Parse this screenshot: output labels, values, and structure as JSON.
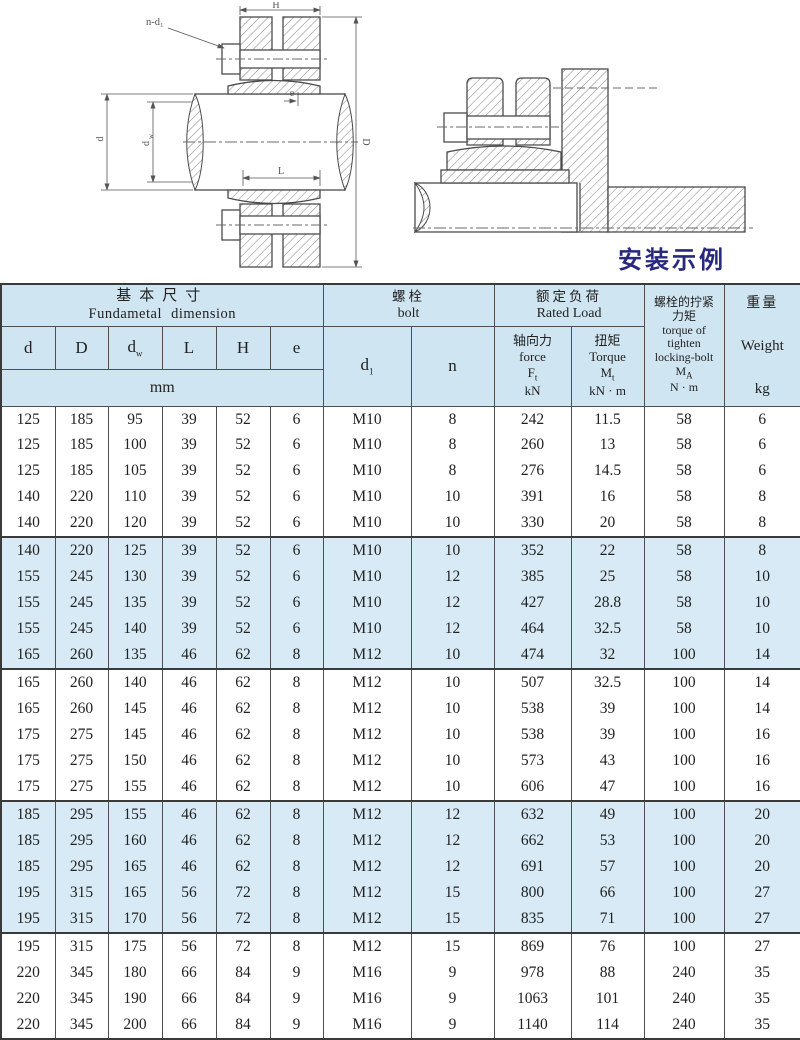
{
  "caption": "安装示例",
  "colors": {
    "caption": "#28287f",
    "header_bg": "#cfe5f1",
    "shaded_row_bg": "#d7eaf5",
    "grid_line": "#4f4f4f",
    "drawing_line": "#4a4a4a"
  },
  "drawing_labels": {
    "H": "H",
    "n_d1": "n-d₁",
    "d": "d",
    "dw_base": "d",
    "dw_sub": "w",
    "e": "e",
    "L": "L",
    "D": "D"
  },
  "table": {
    "groups": {
      "basic": {
        "cn": "基本尺寸",
        "en": "Fundametal dimension",
        "unit": "mm"
      },
      "bolt": {
        "cn": "螺栓",
        "en": "bolt"
      },
      "rated": {
        "cn": "额定负荷",
        "en": "Rated Load"
      },
      "tighten": {
        "cn1": "螺栓的拧紧",
        "cn2": "力矩",
        "en1": "torque of",
        "en2": "tighten",
        "en3": "locking-bolt",
        "sym_base": "M",
        "sym_sub": "A",
        "unit": "N · m"
      },
      "weight": {
        "cn": "重量",
        "en": "Weight",
        "unit": "kg"
      }
    },
    "cols": {
      "d": "d",
      "D": "D",
      "dw_base": "d",
      "dw_sub": "w",
      "L": "L",
      "H": "H",
      "e": "e",
      "d1_base": "d",
      "d1_sub": "1",
      "n": "n",
      "force": {
        "cn": "轴向力",
        "en": "force",
        "sym_base": "F",
        "sym_sub": "t",
        "unit": "kN"
      },
      "torque": {
        "cn": "扭矩",
        "en": "Torque",
        "sym_base": "M",
        "sym_sub": "t",
        "unit": "kN · m"
      }
    },
    "rows": [
      {
        "shaded": false,
        "section_start": false,
        "cells": [
          125,
          185,
          95,
          39,
          52,
          6,
          "M10",
          8,
          242,
          "11.5",
          58,
          6
        ]
      },
      {
        "shaded": false,
        "section_start": false,
        "cells": [
          125,
          185,
          100,
          39,
          52,
          6,
          "M10",
          8,
          260,
          13,
          58,
          6
        ]
      },
      {
        "shaded": false,
        "section_start": false,
        "cells": [
          125,
          185,
          105,
          39,
          52,
          6,
          "M10",
          8,
          276,
          "14.5",
          58,
          6
        ]
      },
      {
        "shaded": false,
        "section_start": false,
        "cells": [
          140,
          220,
          110,
          39,
          52,
          6,
          "M10",
          10,
          391,
          16,
          58,
          8
        ]
      },
      {
        "shaded": false,
        "section_start": false,
        "cells": [
          140,
          220,
          120,
          39,
          52,
          6,
          "M10",
          10,
          330,
          20,
          58,
          8
        ]
      },
      {
        "shaded": true,
        "section_start": true,
        "cells": [
          140,
          220,
          125,
          39,
          52,
          6,
          "M10",
          10,
          352,
          22,
          58,
          8
        ]
      },
      {
        "shaded": true,
        "section_start": false,
        "cells": [
          155,
          245,
          130,
          39,
          52,
          6,
          "M10",
          12,
          385,
          25,
          58,
          10
        ]
      },
      {
        "shaded": true,
        "section_start": false,
        "cells": [
          155,
          245,
          135,
          39,
          52,
          6,
          "M10",
          12,
          427,
          "28.8",
          58,
          10
        ]
      },
      {
        "shaded": true,
        "section_start": false,
        "cells": [
          155,
          245,
          140,
          39,
          52,
          6,
          "M10",
          12,
          464,
          "32.5",
          58,
          10
        ]
      },
      {
        "shaded": true,
        "section_start": false,
        "cells": [
          165,
          260,
          135,
          46,
          62,
          8,
          "M12",
          10,
          474,
          32,
          100,
          14
        ]
      },
      {
        "shaded": false,
        "section_start": true,
        "cells": [
          165,
          260,
          140,
          46,
          62,
          8,
          "M12",
          10,
          507,
          "32.5",
          100,
          14
        ]
      },
      {
        "shaded": false,
        "section_start": false,
        "cells": [
          165,
          260,
          145,
          46,
          62,
          8,
          "M12",
          10,
          538,
          39,
          100,
          14
        ]
      },
      {
        "shaded": false,
        "section_start": false,
        "cells": [
          175,
          275,
          145,
          46,
          62,
          8,
          "M12",
          10,
          538,
          39,
          100,
          16
        ]
      },
      {
        "shaded": false,
        "section_start": false,
        "cells": [
          175,
          275,
          150,
          46,
          62,
          8,
          "M12",
          10,
          573,
          43,
          100,
          16
        ]
      },
      {
        "shaded": false,
        "section_start": false,
        "cells": [
          175,
          275,
          155,
          46,
          62,
          8,
          "M12",
          10,
          606,
          47,
          100,
          16
        ]
      },
      {
        "shaded": true,
        "section_start": true,
        "cells": [
          185,
          295,
          155,
          46,
          62,
          8,
          "M12",
          12,
          632,
          49,
          100,
          20
        ]
      },
      {
        "shaded": true,
        "section_start": false,
        "cells": [
          185,
          295,
          160,
          46,
          62,
          8,
          "M12",
          12,
          662,
          53,
          100,
          20
        ]
      },
      {
        "shaded": true,
        "section_start": false,
        "cells": [
          185,
          295,
          165,
          46,
          62,
          8,
          "M12",
          12,
          691,
          57,
          100,
          20
        ]
      },
      {
        "shaded": true,
        "section_start": false,
        "cells": [
          195,
          315,
          165,
          56,
          72,
          8,
          "M12",
          15,
          800,
          66,
          100,
          27
        ]
      },
      {
        "shaded": true,
        "section_start": false,
        "cells": [
          195,
          315,
          170,
          56,
          72,
          8,
          "M12",
          15,
          835,
          71,
          100,
          27
        ]
      },
      {
        "shaded": false,
        "section_start": true,
        "cells": [
          195,
          315,
          175,
          56,
          72,
          8,
          "M12",
          15,
          869,
          76,
          100,
          27
        ]
      },
      {
        "shaded": false,
        "section_start": false,
        "cells": [
          220,
          345,
          180,
          66,
          84,
          9,
          "M16",
          9,
          978,
          88,
          240,
          35
        ]
      },
      {
        "shaded": false,
        "section_start": false,
        "cells": [
          220,
          345,
          190,
          66,
          84,
          9,
          "M16",
          9,
          1063,
          101,
          240,
          35
        ]
      },
      {
        "shaded": false,
        "section_start": false,
        "cells": [
          220,
          345,
          200,
          66,
          84,
          9,
          "M16",
          9,
          1140,
          114,
          240,
          35
        ]
      }
    ]
  }
}
